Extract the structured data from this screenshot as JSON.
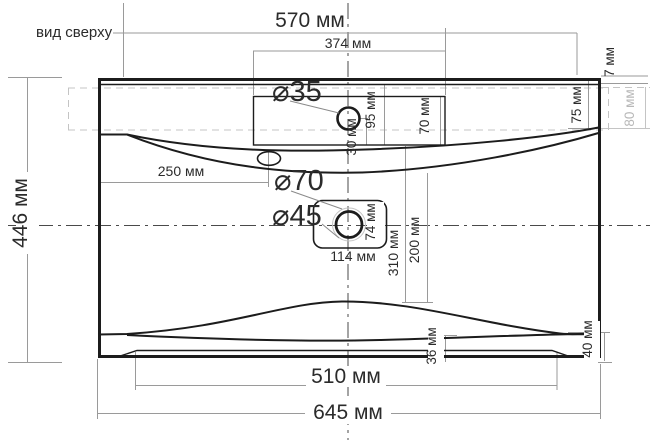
{
  "view": {
    "label": "вид сверху"
  },
  "colors": {
    "line": "#1c1c1c",
    "dimension_line": "#9a9a9a",
    "hidden_line": "#c4c4c4",
    "text": "#2b2b2b",
    "muted_text": "#b8b8b8",
    "background": "#ffffff"
  },
  "dimensions": {
    "top_width": "570 мм",
    "platform_width": "374 мм",
    "overflow_offset": "250 мм",
    "overall_depth": "446 мм",
    "front_lip_width": "510 мм",
    "overall_width": "645 мм",
    "rim_depth": "7 мм",
    "right_edge_top": "75 мм",
    "hidden_depth": "80 мм",
    "faucet_inset": "30 мм",
    "platform_depth": "95 мм",
    "platform_inner_depth": "70 мм",
    "drain_recess_width": "114 мм",
    "drain_recess_depth": "74 мм",
    "drain_distance": "310 мм",
    "drain_distance_inner": "200 мм",
    "front_inset": "36 мм",
    "right_edge_bottom": "40 мм"
  },
  "diameters": {
    "faucet_hole": "⌀35",
    "drain_outer": "⌀70",
    "drain_hole": "⌀45"
  }
}
